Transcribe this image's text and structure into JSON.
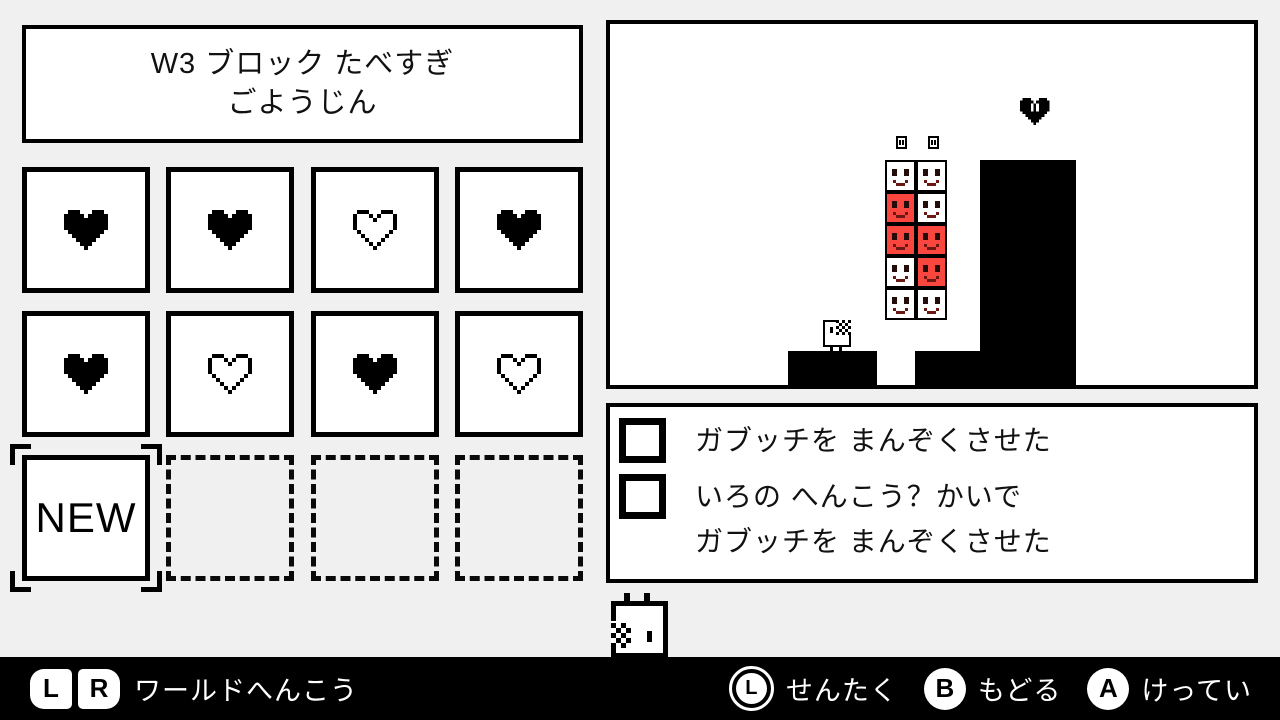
{
  "title": {
    "line1": "W3 ブロック たべすぎ",
    "line2": "ごようじん"
  },
  "level_grid": {
    "tiles": [
      {
        "id": 1,
        "icon": "heart-filled"
      },
      {
        "id": 2,
        "icon": "heart-filled"
      },
      {
        "id": 3,
        "icon": "heart-outline"
      },
      {
        "id": 4,
        "icon": "heart-filled"
      },
      {
        "id": 5,
        "icon": "heart-filled"
      },
      {
        "id": 6,
        "icon": "heart-outline"
      },
      {
        "id": 7,
        "icon": "heart-filled"
      },
      {
        "id": 8,
        "icon": "heart-outline"
      },
      {
        "id": 9,
        "icon": "new",
        "label": "NEW",
        "selected": true
      },
      {
        "id": 10,
        "icon": "empty"
      },
      {
        "id": 11,
        "icon": "empty"
      },
      {
        "id": 12,
        "icon": "empty"
      }
    ]
  },
  "preview": {
    "block_stack": {
      "columns": 2,
      "rows": 5,
      "cells": [
        [
          "white",
          "white"
        ],
        [
          "red",
          "white"
        ],
        [
          "red",
          "red"
        ],
        [
          "white",
          "red"
        ],
        [
          "white",
          "white"
        ]
      ]
    },
    "sprites": [
      "gabucchi",
      "heart",
      "mini-block",
      "mini-block"
    ]
  },
  "challenges": {
    "items": [
      {
        "checked": false,
        "lines": [
          "ガブッチを まんぞくさせた"
        ]
      },
      {
        "checked": false,
        "lines": [
          "いろの へんこう？かいで",
          "ガブッチを まんぞくさせた"
        ]
      }
    ]
  },
  "footer": {
    "left": {
      "buttons": [
        "L",
        "R"
      ],
      "label": "ワールドへんこう"
    },
    "right": [
      {
        "button": "L",
        "type": "stick",
        "label": "せんたく"
      },
      {
        "button": "B",
        "type": "face",
        "label": "もどる"
      },
      {
        "button": "A",
        "type": "face",
        "label": "けってい"
      }
    ]
  },
  "colors": {
    "block_red": "#f9473f",
    "page_bg": "#f0f0f0",
    "panel_bg": "#ffffff",
    "ink": "#000000",
    "footer_bg": "#000000",
    "footer_text": "#ffffff"
  }
}
